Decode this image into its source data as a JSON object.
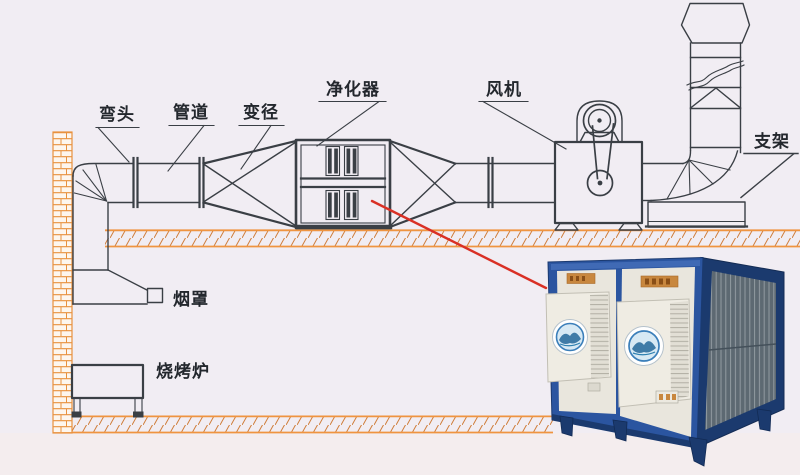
{
  "diagram": {
    "labels": {
      "elbow": "弯头",
      "duct": "管道",
      "reducer": "变径",
      "purifier": "净化器",
      "fan": "风机",
      "bracket": "支架",
      "hood": "烟罩",
      "grill": "烧烤炉"
    }
  },
  "colors": {
    "line": "#3a3f45",
    "callout_red": "#d93025",
    "brick_orange": "#e8913f",
    "hatch_stroke": "#cf7d3a",
    "band_stroke": "#ef9440",
    "bg": "#f1edf3",
    "bg_lower": "#f4edee",
    "product_frame": "#2b55a0",
    "product_frame_dark": "#1b3a6e",
    "product_panel": "#e9e6dd",
    "product_panel_raised": "#efece3",
    "filter_dark": "#5d6972",
    "filter_pleat": "#9fa8ad",
    "label_orange": "#c8873e",
    "logo_blue": "#3b7fba",
    "text": "#23272d"
  }
}
